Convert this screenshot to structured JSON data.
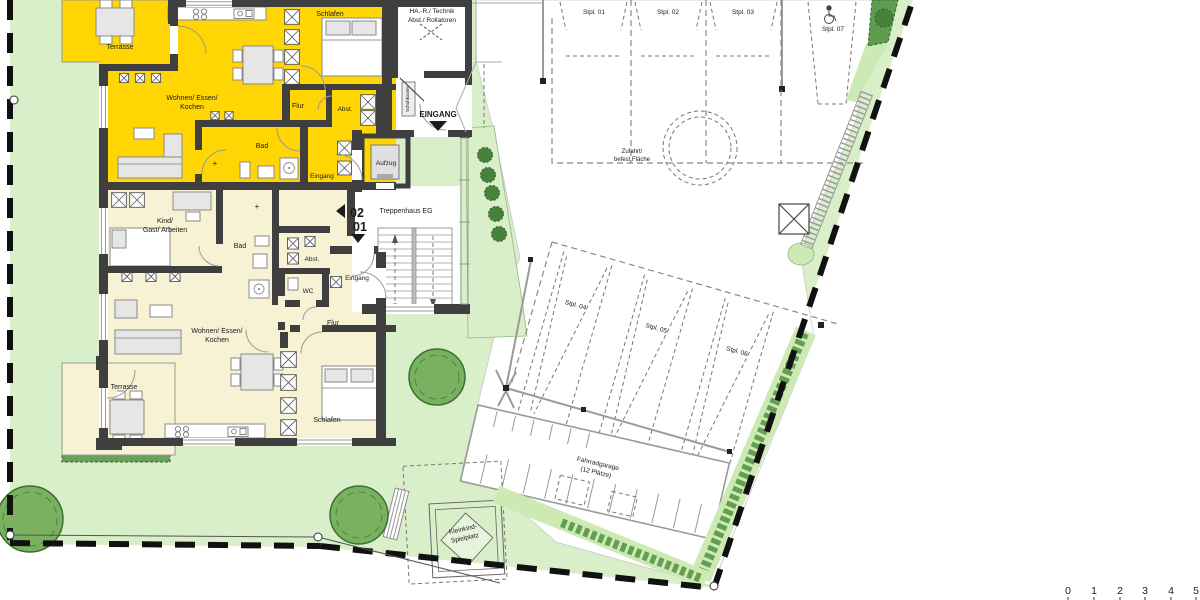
{
  "plan_type": "ground-floor site plan",
  "colors": {
    "lawn": "#d9efca",
    "paved": "#ffffff",
    "apartment_upper": "#ffd504",
    "apartment_lower": "#f7f2d3",
    "wall": "#3f3f3f",
    "hedge": "#5f9c4e",
    "hedge_light": "#cdeab5",
    "tree": "#79b161",
    "boundary": "#111111"
  },
  "apartment_upper": {
    "number": "02",
    "terrasse": "Terrasse",
    "wohnen_1": "Wohnen/ Essen/",
    "wohnen_2": "Kochen",
    "schlafen": "Schlafen",
    "flur": "Flur",
    "abst": "Abst.",
    "bad": "Bad",
    "eingang": "Eingang"
  },
  "apartment_lower": {
    "number": "01",
    "kind_1": "Kind/",
    "kind_2": "Gast/ Arbeiten",
    "bad": "Bad",
    "abst": "Abst.",
    "wc": "WC",
    "eingang": "Eingang",
    "flur": "Flur",
    "wohnen_1": "Wohnen/ Essen/",
    "wohnen_2": "Kochen",
    "schlafen": "Schlafen",
    "terrasse": "Terrasse"
  },
  "common": {
    "technik_1": "HA.-R./ Technik",
    "technik_2": "Abst./ Rollatoren",
    "eingang": "EINGANG",
    "aufzug": "Aufzug",
    "treppenhaus": "Treppenhaus EG",
    "schuhkasten": "Schuhkasten"
  },
  "site": {
    "zufahrt_1": "Zufahrt/",
    "zufahrt_2": "befest Fläche",
    "fahrradgarage_1": "Fahrradgarage",
    "fahrradgarage_2": "(12 Plätze)",
    "spielplatz_1": "Kleinkind-",
    "spielplatz_2": "Spielplatz"
  },
  "parking": {
    "s01": "Stpl. 01",
    "s02": "Stpl. 02",
    "s03": "Stpl. 03",
    "s04": "Stpl. 04",
    "s05": "Stpl. 05",
    "s06": "Stpl. 06",
    "s07": "Stpl. 07"
  },
  "scale_bar": {
    "t0": "0",
    "t1": "1",
    "t2": "2",
    "t3": "3",
    "t4": "4",
    "t5": "5"
  }
}
